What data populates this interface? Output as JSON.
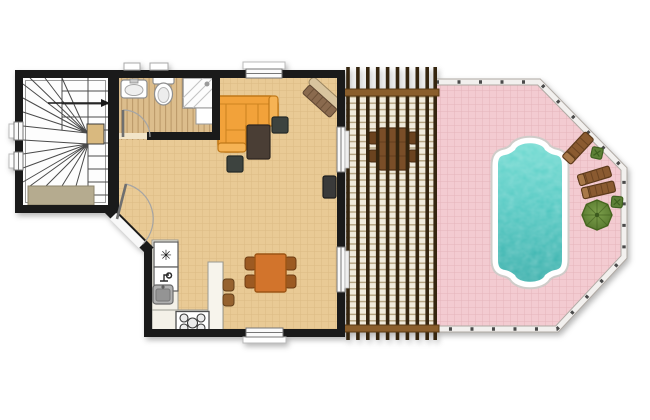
{
  "app": {
    "type": "architectural-floor-plan",
    "description": "Single-storey house plan with winder staircase, bathroom, open living/kitchen/dining space, covered pergola terrace and octagonal pool deck"
  },
  "colors": {
    "wall": "#1a1a1a",
    "floor_wood": "#e9ca95",
    "bathroom_plank": "#dcbd8c",
    "stair_room": "#fdfdfd",
    "doormat": "#b5ab8f",
    "sofa": "#f2a23a",
    "sofa_edge": "#c07818",
    "coffee_table": "#4a3e35",
    "side_table": "#3d433f",
    "dining_table": "#d2742c",
    "chair": "#9c5a22",
    "counter": "#f4f1e8",
    "kitchen_sink": "#b0b0b0",
    "stool": "#96622f",
    "pergola_bg": "#f1ebdc",
    "pergola_rafter": "#35250f",
    "pergola_beam": "#8a5e2c",
    "pergola_table": "#7a4e28",
    "deck_pink": "#f3cbd1",
    "railing_white": "#f2f0ee",
    "pool_coping": "#ffffff",
    "water_light": "#6fdcd2",
    "water_dark": "#2ba8a4",
    "lounger": "#8a5a30",
    "planter": "#5d8036",
    "parasol": "#6a8c3e"
  },
  "house": {
    "staircase": {
      "features": [
        "winder-stairs",
        "up-direction-arrow",
        "landing",
        "doormat"
      ],
      "windows": 2
    },
    "bathroom": {
      "fixtures": [
        "wash-basin",
        "toilet",
        "shower",
        "cabinet"
      ],
      "door": "hinged"
    },
    "living_room": {
      "furniture": [
        "corner-sofa",
        "coffee-table",
        "side-table",
        "side-table",
        "bench-sideboard",
        "wall-tv"
      ],
      "windows": 1
    },
    "kitchen": {
      "fixtures": [
        "fridge-freezer",
        "dishwasher",
        "sink",
        "stove-4-burners",
        "peninsula"
      ],
      "stools": 2
    },
    "dining_area": {
      "furniture": [
        "dining-table"
      ],
      "chairs": 4,
      "windows": 1
    },
    "doors": [
      "entrance-door-on-diagonal-wall",
      "bathroom-door",
      "terrace-door-upper",
      "terrace-door-lower"
    ]
  },
  "pergola": {
    "structure": [
      "rafters",
      "battens",
      "top-beam",
      "bottom-beam"
    ],
    "furniture": {
      "table": 1,
      "chairs": 4
    }
  },
  "pool_deck": {
    "shape": "octagonal-with-railing",
    "pool_style": "roman-end",
    "furniture": [
      "sun-lounger",
      "sun-lounger",
      "sun-lounger",
      "planter",
      "planter",
      "parasol-table"
    ]
  },
  "icons": {
    "fridge": "snowflake-asterisk",
    "stair_direction": "right-arrow"
  },
  "glyphs": {
    "fridge_asterisk": "✳"
  }
}
